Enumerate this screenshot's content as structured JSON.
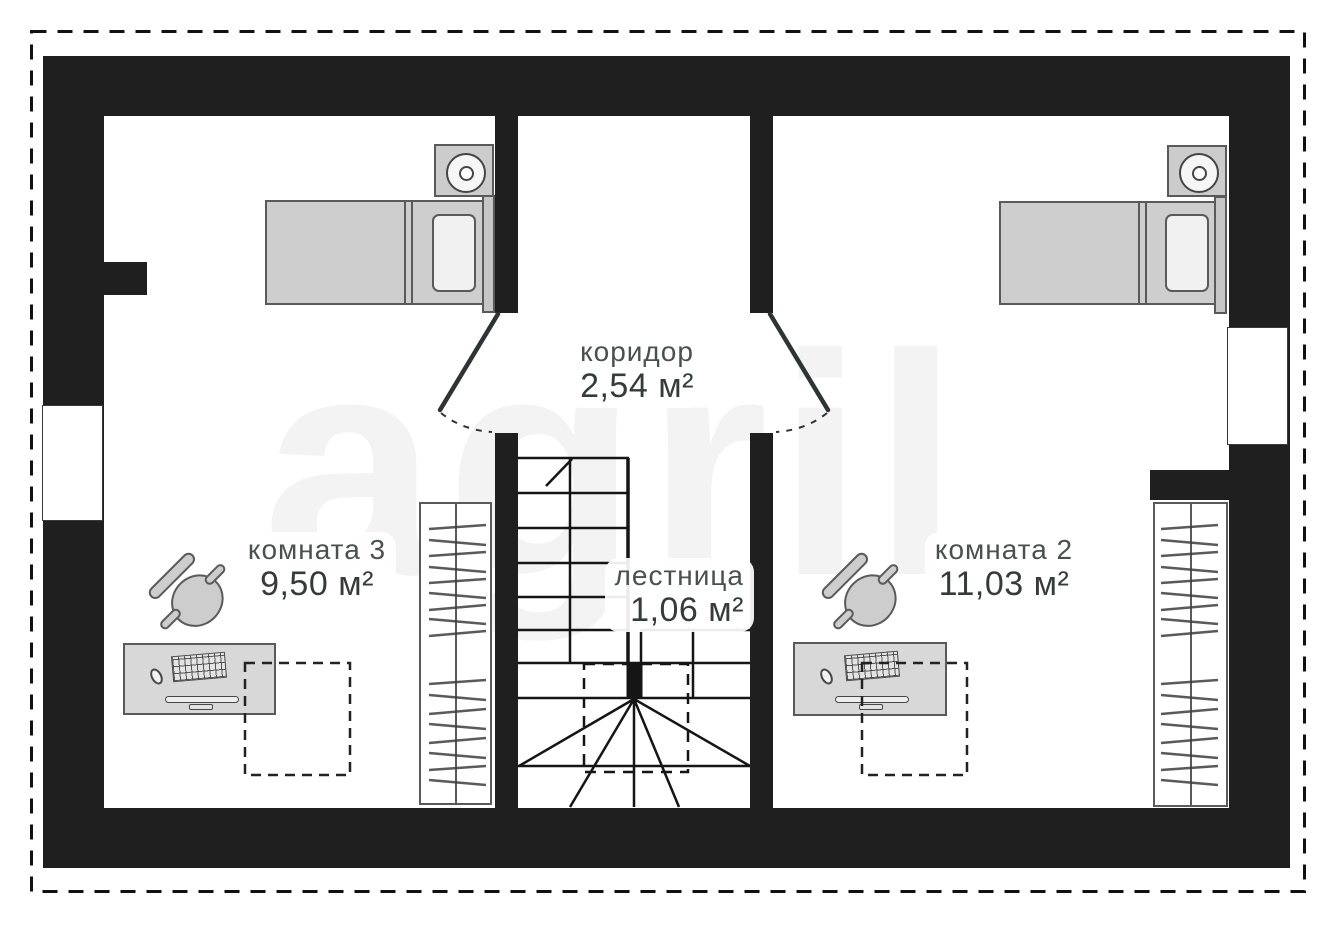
{
  "watermark": {
    "text": "agril"
  },
  "labels": {
    "corridor": {
      "name": "коридор",
      "area": "2,54 м²"
    },
    "room3": {
      "name": "комната 3",
      "area": "9,50 м²"
    },
    "room2": {
      "name": "комната 2",
      "area": "11,03 м²"
    },
    "stairs": {
      "name": "лестница",
      "area": "1,06 м²"
    }
  },
  "colors": {
    "wall": "#1f1f1f",
    "furniture_fill": "#cecece",
    "furniture_stroke": "#5a5a5a",
    "label_name_text": "#4a504d",
    "label_area_text": "#353b39",
    "watermark": "#f2f2f2",
    "background": "#ffffff"
  }
}
